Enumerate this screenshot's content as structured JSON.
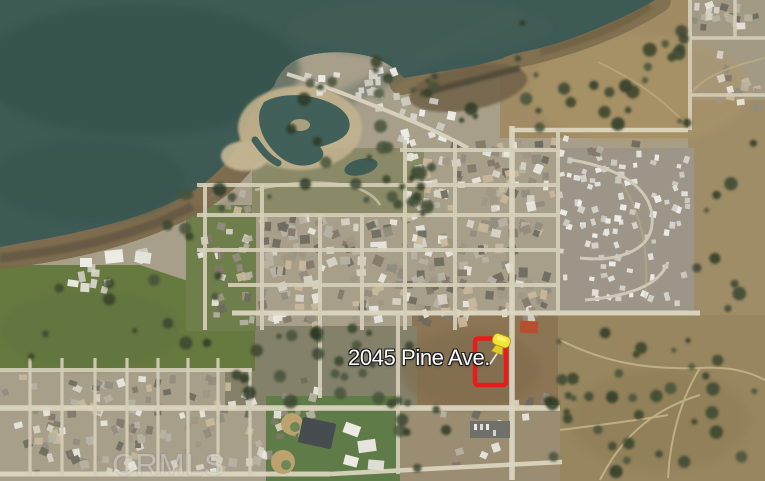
{
  "map": {
    "address_label": "2045 Pine Ave.",
    "watermark": "CRMLS",
    "marker": {
      "boundary_color": "#e81c1c",
      "pin_color": "#f4e535"
    },
    "colors": {
      "water": "#3d5a54"
    }
  }
}
